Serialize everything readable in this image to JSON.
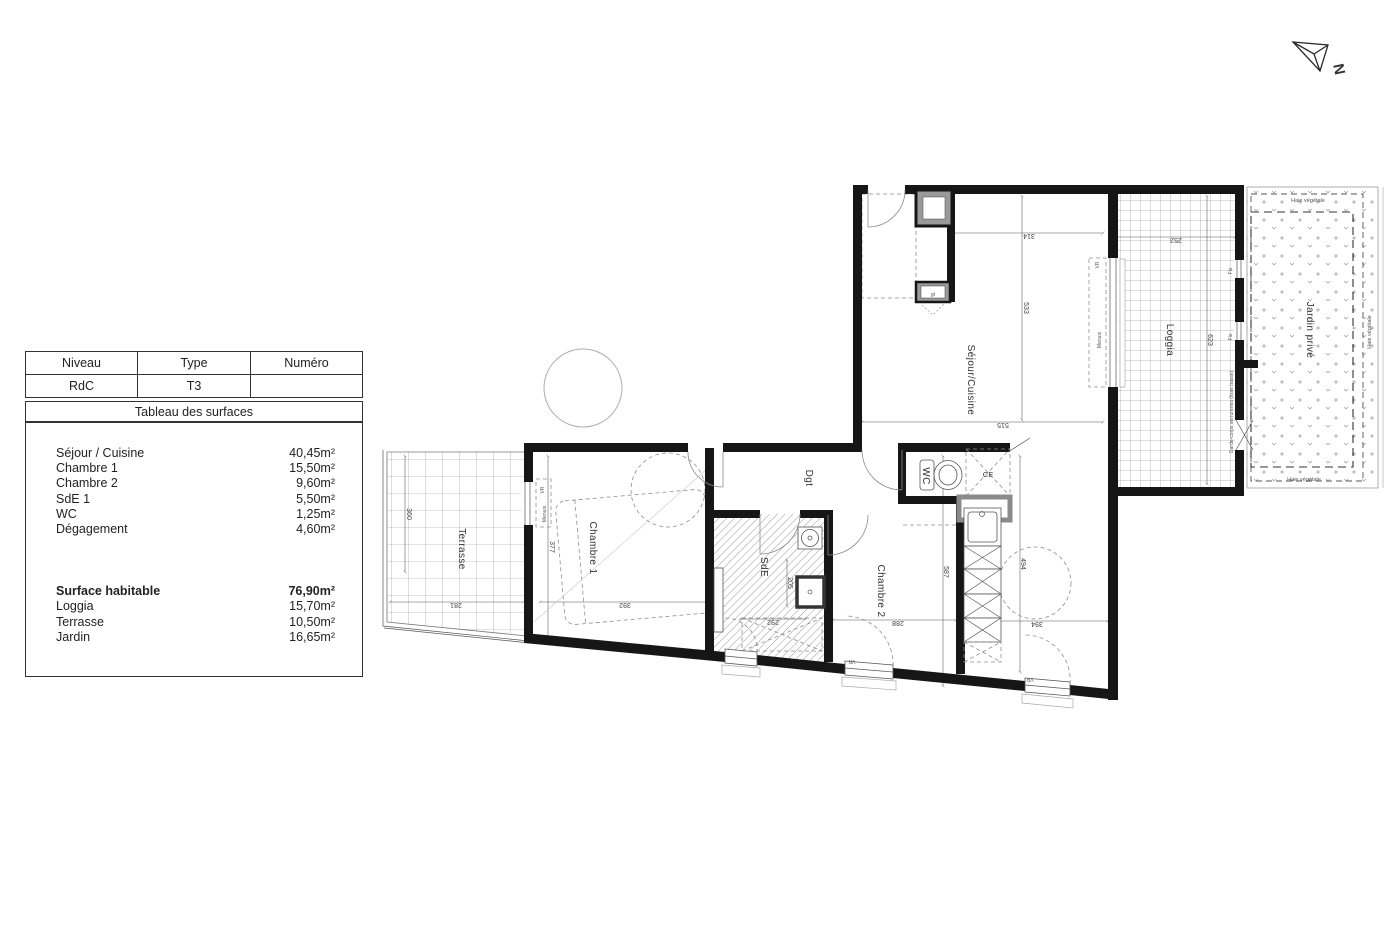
{
  "north": {
    "label": "N"
  },
  "surface_table": {
    "headers": {
      "level": "Niveau",
      "type": "Type",
      "number": "Numéro"
    },
    "values": {
      "level": "RdC",
      "type": "T3",
      "number": ""
    },
    "section_title": "Tableau des surfaces",
    "rooms": [
      {
        "label": "Séjour / Cuisine",
        "area": "40,45m²"
      },
      {
        "label": "Chambre 1",
        "area": "15,50m²"
      },
      {
        "label": "Chambre 2",
        "area": "9,60m²"
      },
      {
        "label": "SdE 1",
        "area": "5,50m²"
      },
      {
        "label": "WC",
        "area": "1,25m²"
      },
      {
        "label": "Dégagement",
        "area": "4,60m²"
      }
    ],
    "totals": [
      {
        "label": "Surface habitable",
        "area": "76,90m²"
      },
      {
        "label": "Loggia",
        "area": "15,70m²"
      },
      {
        "label": "Terrasse",
        "area": "10,50m²"
      },
      {
        "label": "Jardin",
        "area": "16,65m²"
      }
    ]
  },
  "plan": {
    "rooms": {
      "sejour": "Séjour/Cuisine",
      "loggia": "Loggia",
      "jardin": "Jardin privé",
      "terrasse": "Terrasse",
      "chambre1": "Chambre 1",
      "chambre2": "Chambre 2",
      "sde": "SdE",
      "dgt": "Dgt",
      "wc": "WC",
      "ce": "CE"
    },
    "dims": {
      "d314": "314",
      "d533": "533",
      "d515": "515",
      "d252": "252",
      "d623": "623",
      "d360": "360",
      "d281": "281",
      "d377": "377",
      "d392": "392",
      "d292": "292",
      "d205": "205",
      "d288": "288",
      "d587": "587",
      "d494": "494",
      "d394": "394"
    },
    "annotations": {
      "vr": "VR",
      "menuis": "Menuis",
      "fix": "Fix",
      "gt": "gt",
      "haie": "Haie végétale",
      "garde_corps": "Garde-corps serrureries (lisse basse)"
    }
  }
}
